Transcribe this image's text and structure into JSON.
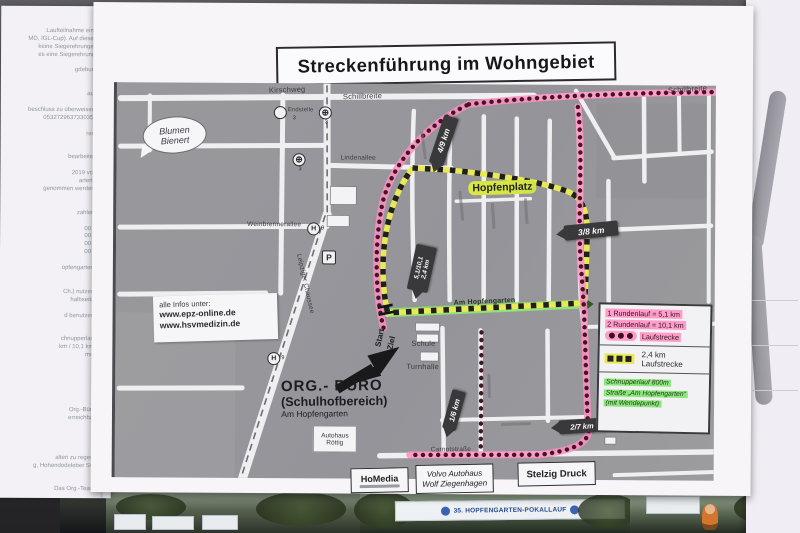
{
  "title": "Streckenführung im Wohngebiet",
  "left_paper": {
    "lines": [
      "",
      "Laufteilnahme eine",
      "MD, IGL-Cup). Auf diesen",
      "keine Siegerehrungen",
      "es eine Siegerehrung.",
      "",
      "gdeburg",
      "",
      "",
      "aus",
      "",
      "beschluss zu überweisen.",
      "0532729637330357",
      "",
      "ren.",
      "",
      "",
      "bearbeitet!",
      "",
      "2019 von",
      "arten\".",
      "genommen werden.",
      "",
      "",
      "zahlen.",
      "",
      "00 €",
      "00 €",
      "00 €",
      "00 €",
      "",
      "opfengarten\"",
      "",
      "",
      "Ch.) nutzen.",
      "halbseitig",
      "",
      "d benutzen!",
      "",
      "",
      "chnupperlauf",
      "km / 10,1 km)",
      "mer",
      "",
      "",
      "",
      "",
      "",
      "",
      "Org.-Büro",
      "erreichbar",
      "",
      "",
      "",
      "",
      "alten zu regen.",
      "g, Hohendodeleber Str.",
      "",
      "",
      "Das Org.-Team"
    ]
  },
  "map": {
    "streets": {
      "kirschweg": "Kirschweg",
      "schillbreite_west": "Schillbreite",
      "schillbreite_east": "Schillbreite",
      "lindenallee": "Lindenallee",
      "weinbrennerallee": "Weinbrennerallee",
      "leipziger_chaussee": "Leipziger Chaussee",
      "am_hopfengarten": "Am Hopfengarten",
      "carnotstrasse": "Carnotstraße"
    },
    "places": {
      "hopfenplatz": "Hopfenplatz",
      "blumen_1": "Blumen",
      "blumen_2": "Bienert",
      "endstelle": "Endstelle",
      "schule": "Schule",
      "turnhalle": "Turnhalle",
      "autohaus_1": "Autohaus",
      "autohaus_2": "Röttig",
      "start": "Start",
      "ziel": "Ziel"
    },
    "icons": {
      "tram_symbol": "⊕",
      "tram_line": "3",
      "stop": "H",
      "bus_line": "9",
      "parking": "P"
    },
    "info_box": {
      "line1": "alle Infos unter:",
      "line2": "www.epz-online.de",
      "line3": "www.hsvmedizin.de"
    },
    "org_buero": {
      "line1": "ORG.- BÜRO",
      "line2": "(Schulhofbereich)",
      "line3": "Am Hopfengarten"
    },
    "km_markers": {
      "k49": "4/9 km",
      "k38": "3/8 km",
      "kmid1": "5,1/10,1",
      "kmid2": "2,4 km",
      "k16": "1/6 km",
      "k27": "2/7 km"
    },
    "legend": {
      "run1": "1 Rundenlauf = 5,1 km",
      "run2": "2 Rundenlauf = 10,1 km",
      "lauf1": "Laufstrecke",
      "km24": "2,4 km",
      "lauf2": "Laufstrecke",
      "snack1": "Schnupperlauf 800m",
      "snack2": "Straße „Am Hopfengarten“",
      "snack3": "(mit Wendepunkt)"
    },
    "colors": {
      "route_pink": "#ff8fc2",
      "route_dot": "#451424",
      "route_yellow": "#e9e955",
      "route_green": "#8ce06a",
      "marker_dark": "#39393c",
      "map_gray": "#98989c"
    }
  },
  "sponsors": {
    "homedia": "HoMedia",
    "volvo1": "Volvo Autohaus",
    "volvo2": "Wolf Ziegenhagen",
    "stelzig": "Stelzig Druck"
  },
  "bottom_strip": {
    "banner": "35. HOPFENGARTEN-POKALLAUF"
  }
}
